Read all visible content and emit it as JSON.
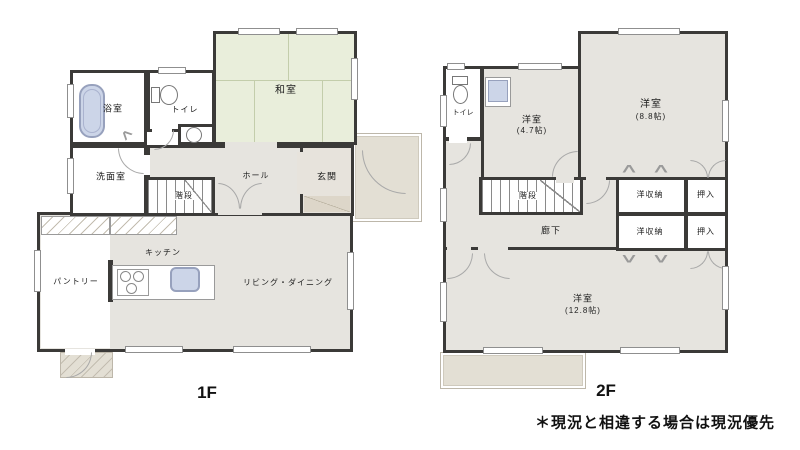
{
  "floor1": {
    "label": "1F",
    "rooms": {
      "bath": "浴室",
      "toilet": "トイレ",
      "washroom": "洗面室",
      "stairs": "階段",
      "hall": "ホール",
      "entrance": "玄関",
      "japanese_room": "和室",
      "pantry": "パントリー",
      "kitchen": "キッチン",
      "living_dining": "リビング・ダイニング"
    }
  },
  "floor2": {
    "label": "2F",
    "rooms": {
      "toilet": "トイレ",
      "western_room_small": "洋室",
      "western_room_medium": "洋室",
      "western_room_large": "洋室",
      "stairs": "階段",
      "corridor": "廊下",
      "closet_top": "洋収納",
      "closet_bottom": "洋収納",
      "oshiire_top": "押入",
      "oshiire_bottom": "押入"
    },
    "sizes": {
      "western_room_small": "(4.7帖)",
      "western_room_medium": "(8.8帖)",
      "western_room_large": "(12.8帖)"
    }
  },
  "note": "＊現況と相違する場合は現況優先",
  "colors": {
    "wall": "#3b3a38",
    "floor": "#e6e4df",
    "tatami": "#e9eedb",
    "exterior": "#e3dfd4",
    "fixture_blue": "#ccd5e8"
  }
}
